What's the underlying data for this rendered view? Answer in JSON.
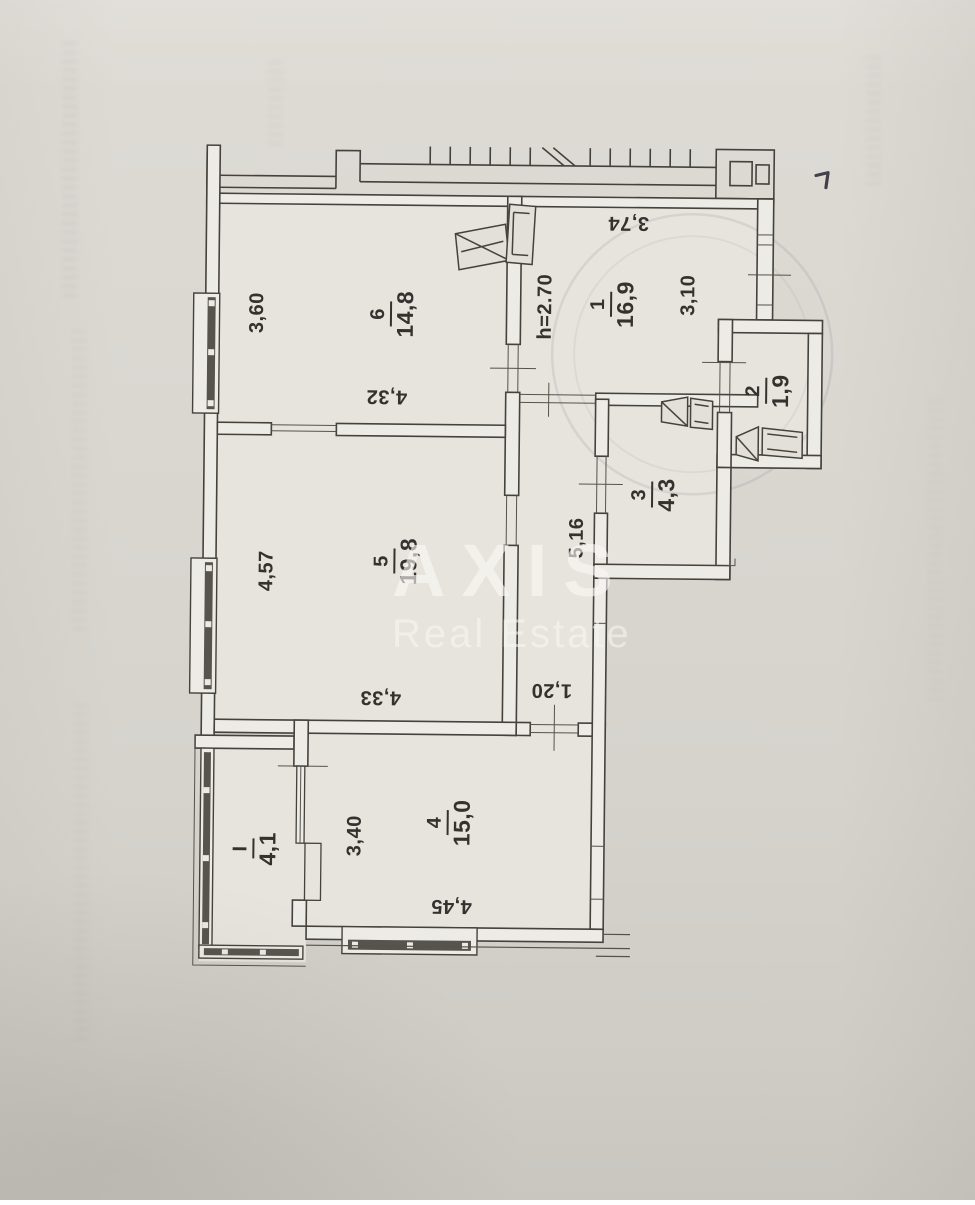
{
  "watermark": {
    "name": "AXIS",
    "tagline": "Real Estate"
  },
  "plan": {
    "ceiling_height": "h=2.70",
    "rooms": [
      {
        "number": "6",
        "area": "14,8"
      },
      {
        "number": "1",
        "area": "16,9"
      },
      {
        "number": "2",
        "area": "1,9"
      },
      {
        "number": "3",
        "area": "4,3"
      },
      {
        "number": "5",
        "area": "19,8"
      },
      {
        "number": "4",
        "area": "15,0"
      },
      {
        "number": "I",
        "area": "4,1"
      }
    ],
    "dimensions": {
      "room6_width": "3,60",
      "room6_length": "4,32",
      "room5_width": "4,57",
      "room5_length": "4,33",
      "room4_width": "3,40",
      "room4_length": "4,45",
      "room1_width": "3,74",
      "room1_length": "3,10",
      "corridor_length": "5,16",
      "corridor_opening": "1,20"
    }
  }
}
